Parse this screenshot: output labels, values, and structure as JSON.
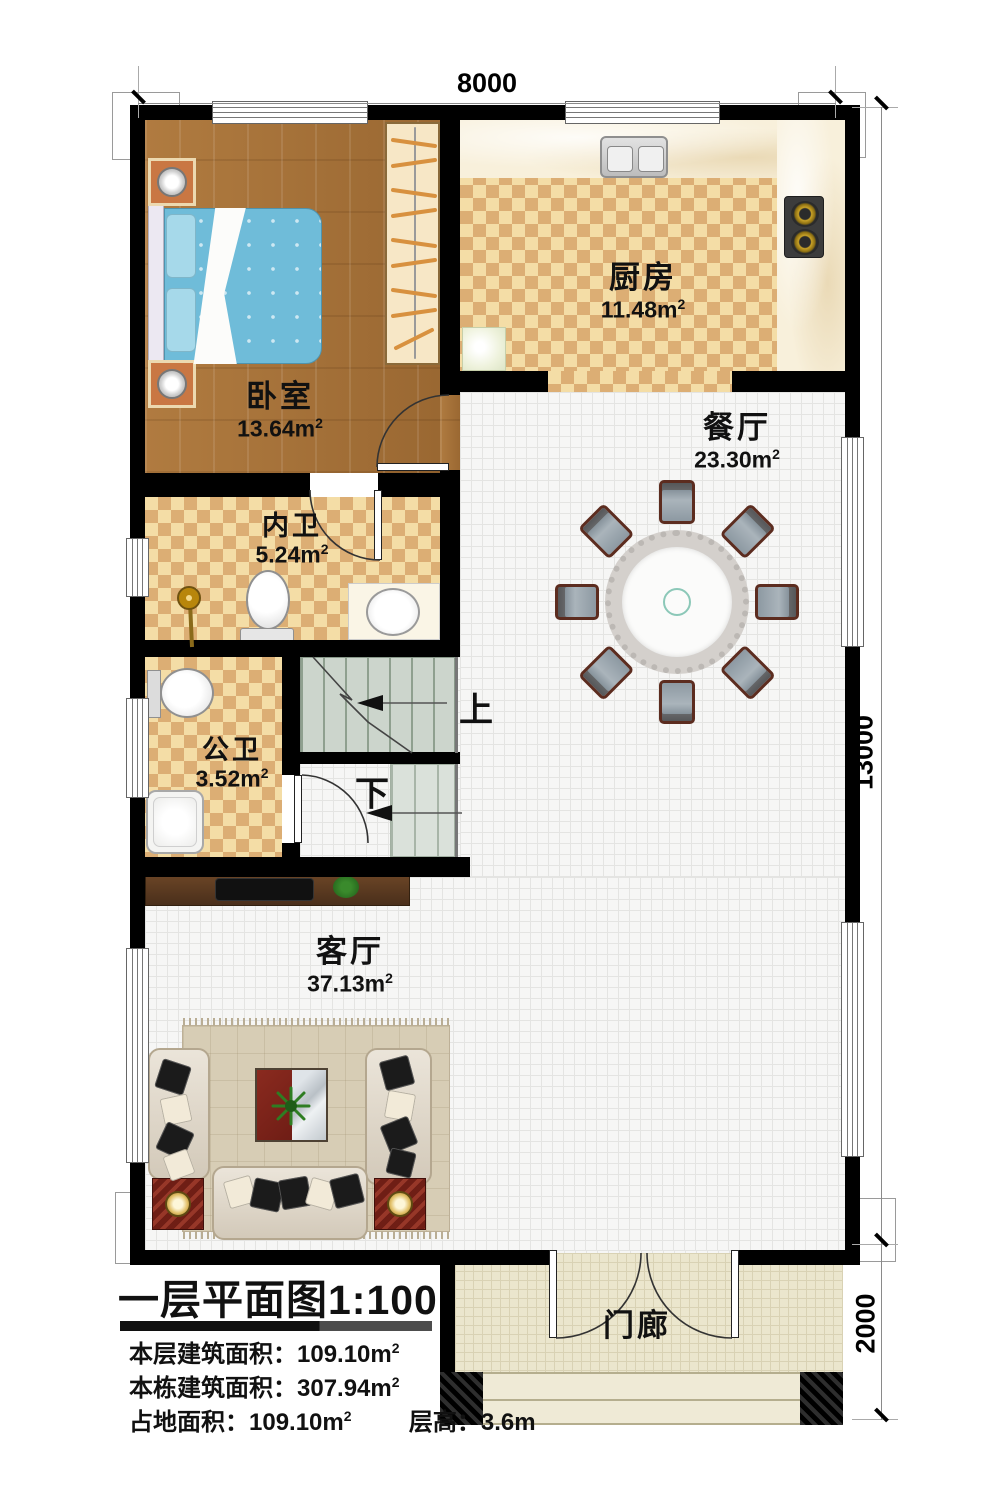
{
  "plan": {
    "dimensions": {
      "width_top": "8000",
      "height_right": "13000",
      "porch_height": "2000"
    },
    "rooms": {
      "bedroom": {
        "name": "卧室",
        "area": "13.64m",
        "sup": "2"
      },
      "kitchen": {
        "name": "厨房",
        "area": "11.48m",
        "sup": "2"
      },
      "dining": {
        "name": "餐厅",
        "area": "23.30m",
        "sup": "2"
      },
      "inner_bath": {
        "name": "内卫",
        "area": "5.24m",
        "sup": "2"
      },
      "public_bath": {
        "name": "公卫",
        "area": "3.52m",
        "sup": "2"
      },
      "living": {
        "name": "客厅",
        "area": "37.13m",
        "sup": "2"
      },
      "porch": {
        "name": "门廊"
      }
    },
    "stairs": {
      "up_label": "上",
      "down_label": "下"
    }
  },
  "title_block": {
    "title": "一层平面图1:100",
    "lines": [
      {
        "label": "本层建筑面积：",
        "value": "109.10m",
        "sup": "2"
      },
      {
        "label": "本栋建筑面积：",
        "value": "307.94m",
        "sup": "2"
      },
      {
        "label": "占地面积：",
        "value": "109.10m",
        "sup": "2"
      },
      {
        "label": "层高：",
        "value": "3.6m",
        "sup": ""
      }
    ]
  },
  "colors": {
    "wall": "#000000",
    "checker_dark": "#dcae74",
    "checker_light": "#f4dda6",
    "wood": "#a9743c",
    "tile": "#f6f6f5",
    "stair": "#ccd5cc",
    "accent_red": "#7a241c"
  }
}
